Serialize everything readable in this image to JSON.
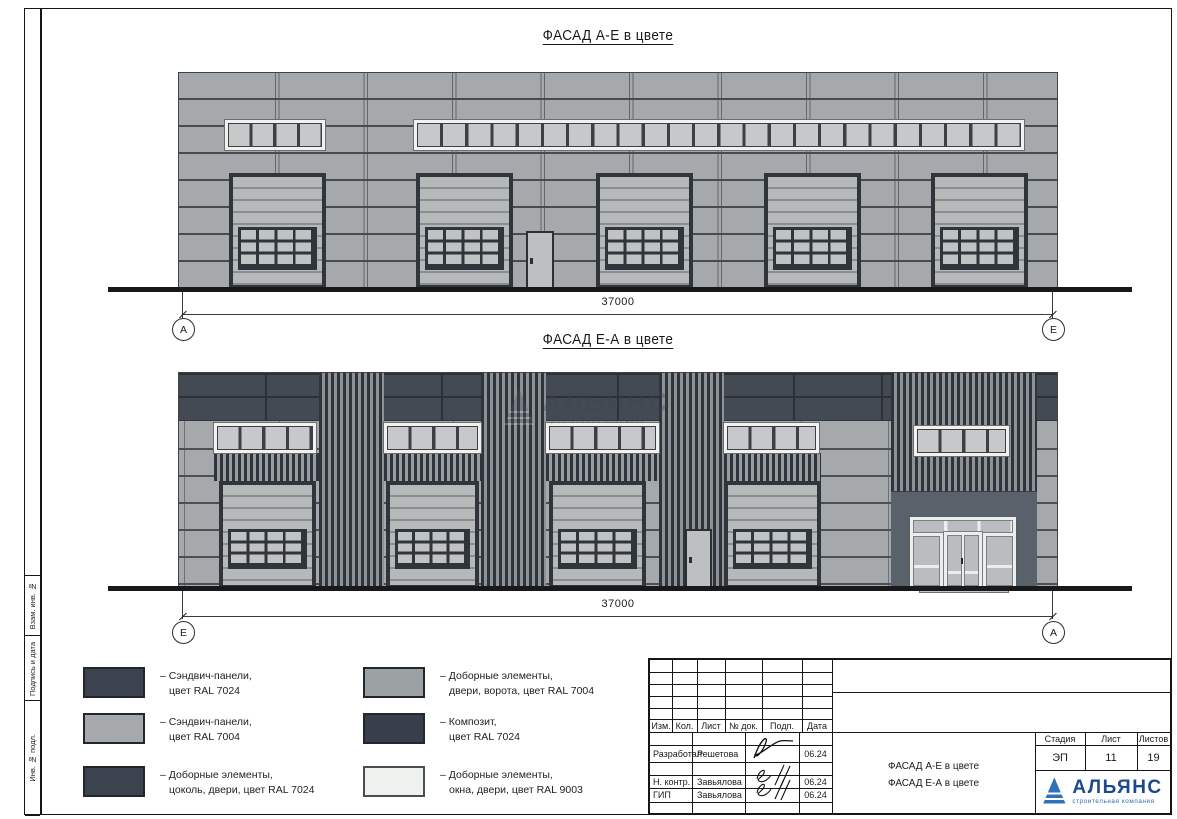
{
  "frame": {
    "sidebar_labels": [
      "Взам. инв. №",
      "Подпись и дата",
      "Инв. № подл."
    ]
  },
  "facades": {
    "f1": {
      "title": "ФАСАД А-Е в цвете",
      "dim": "37000",
      "axis_left": "А",
      "axis_right": "Е"
    },
    "f2": {
      "title": "ФАСАД Е-А в цвете",
      "dim": "37000",
      "axis_left": "Е",
      "axis_right": "А"
    }
  },
  "watermark": {
    "name": "АЛЬЯНС",
    "sub": "строительная компания"
  },
  "legend": {
    "items": [
      {
        "l1": "– Сэндвич-панели,",
        "l2": "цвет RAL 7024",
        "color": "#3d434e"
      },
      {
        "l1": "– Сэндвич-панели,",
        "l2": "цвет RAL 7004",
        "color": "#a6a9ab"
      },
      {
        "l1": "– Доборные элементы,",
        "l2": "цоколь, двери, цвет RAL 7024",
        "color": "#3d434e"
      },
      {
        "l1": "– Доборные элементы,",
        "l2": "двери, ворота, цвет RAL 7004",
        "color": "#9ca1a4"
      },
      {
        "l1": "– Композит,",
        "l2": "цвет RAL 7024",
        "color": "#383f4a"
      },
      {
        "l1": "– Доборные элементы,",
        "l2": "окна, двери, цвет RAL 9003",
        "color": "#edf2ee"
      }
    ]
  },
  "titleblock": {
    "header_cols": [
      "Изм.",
      "Кол.",
      "Лист",
      "№ док.",
      "Подп.",
      "Дата"
    ],
    "rows": [
      {
        "role": "Разработал",
        "name": "Решетова",
        "date": "06.24"
      },
      {
        "role": "Н. контр.",
        "name": "Завьялова",
        "date": "06.24"
      },
      {
        "role": "ГИП",
        "name": "Завьялова",
        "date": "06.24"
      }
    ],
    "stage_label": "Стадия",
    "sheet_label": "Лист",
    "sheets_label": "Листов",
    "stage": "ЭП",
    "sheet_no": "11",
    "sheets_total": "19",
    "doc_title_line1": "ФАСАД А-Е в цвете",
    "doc_title_line2": "ФАСАД Е-А в цвете",
    "company": "АЛЬЯНС",
    "company_sub": "строительная компания",
    "logo_blue": "#1c4a8c"
  }
}
